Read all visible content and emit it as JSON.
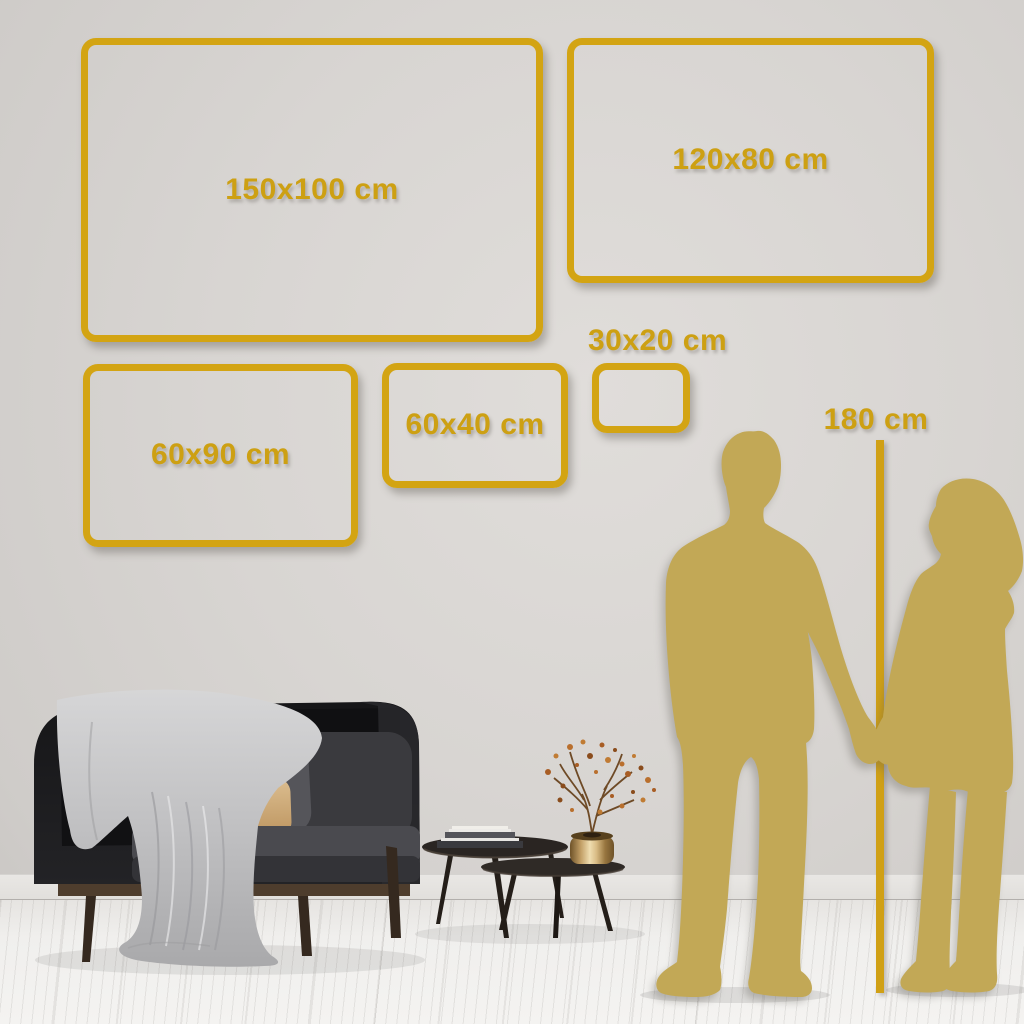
{
  "size_guide": {
    "unit": "cm",
    "frames": [
      {
        "label": "150x100 cm",
        "width_cm": 150,
        "height_cm": 100,
        "label_position": "center"
      },
      {
        "label": "120x80 cm",
        "width_cm": 120,
        "height_cm": 80,
        "label_position": "center"
      },
      {
        "label": "60x90 cm",
        "width_cm": 60,
        "height_cm": 90,
        "label_position": "center"
      },
      {
        "label": "60x40 cm",
        "width_cm": 60,
        "height_cm": 40,
        "label_position": "center"
      },
      {
        "label": "30x20 cm",
        "width_cm": 30,
        "height_cm": 20,
        "label_position": "above"
      }
    ],
    "height_reference": {
      "label": "180 cm",
      "height_cm": 180
    }
  },
  "colors": {
    "frame_gold": "#d3a413",
    "silhouette_gold": "#c2a856",
    "wall": "#d7d4d1",
    "floor": "#f1f0ee"
  },
  "scene": {
    "silhouettes": [
      "man-silhouette",
      "woman-silhouette"
    ],
    "furniture": [
      "sofa",
      "blanket",
      "gray-pillow",
      "tan-pillow",
      "nesting-coffee-tables",
      "books",
      "brass-vase",
      "dried-branch"
    ]
  }
}
